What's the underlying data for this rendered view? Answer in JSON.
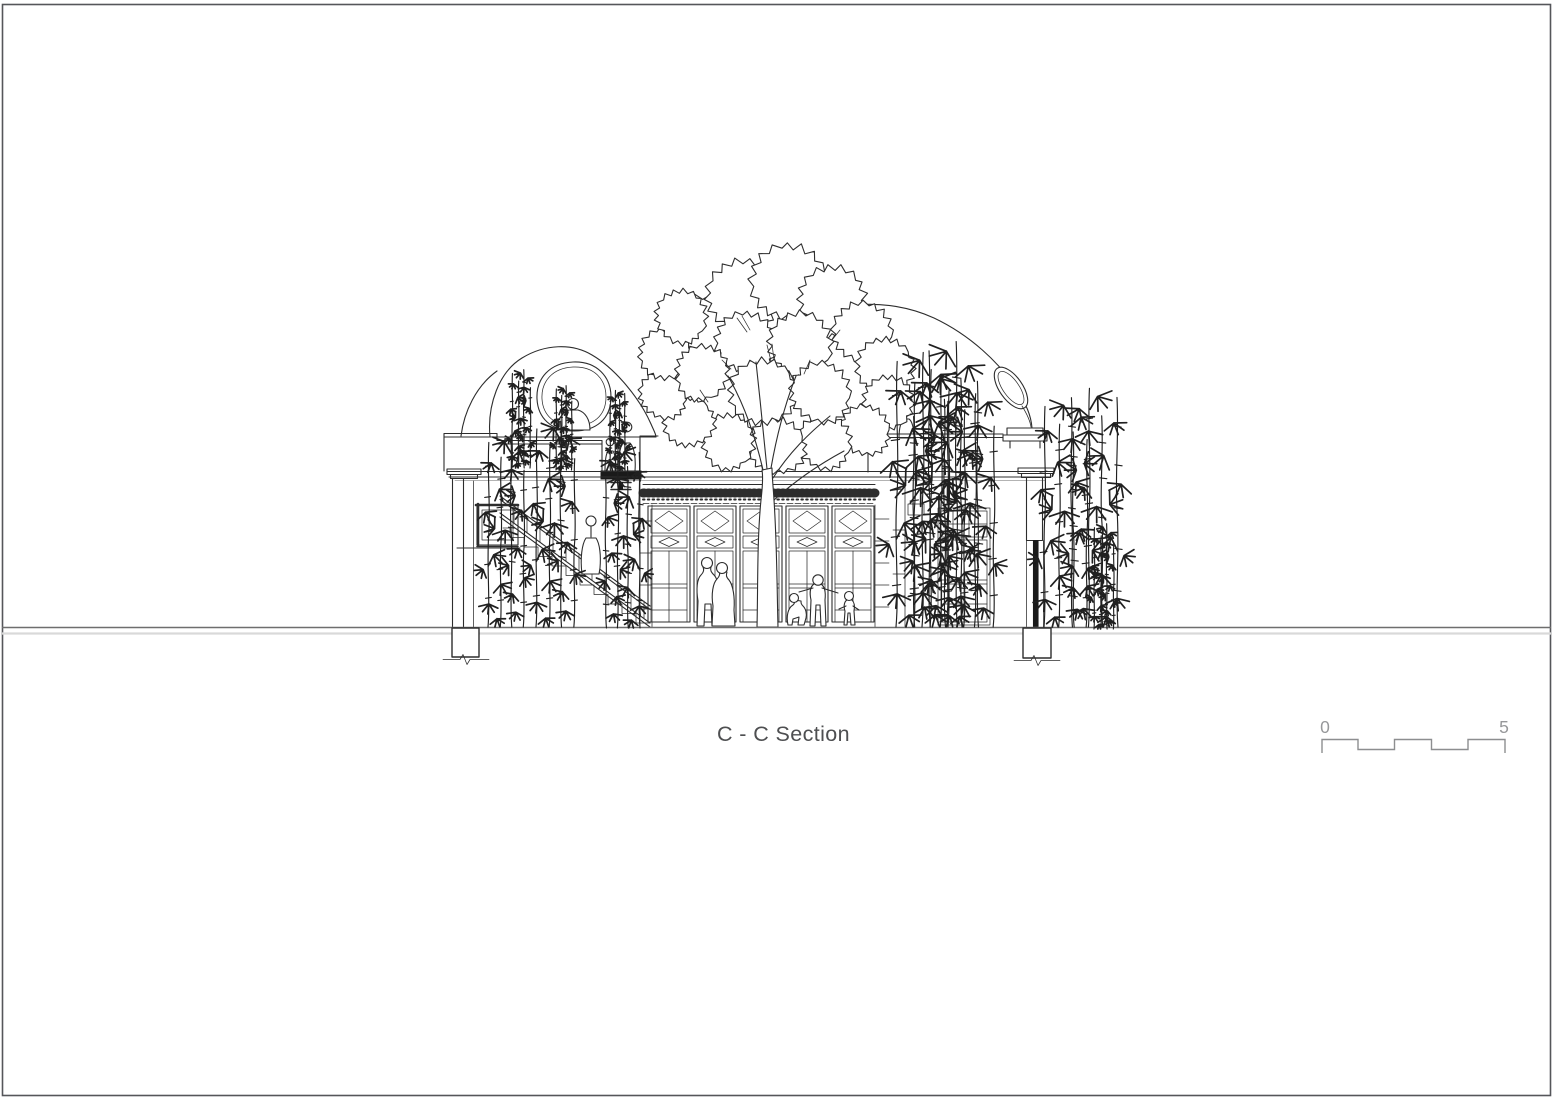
{
  "page": {
    "background": "#ffffff",
    "border_color": "#55565a"
  },
  "drawing": {
    "title": "C - C Section",
    "title_color": "#4e4f51",
    "line_color": "#2d2d2d",
    "cut_fill_color": "#1a1a1a",
    "ground_line_color": "#6e6e6e",
    "ground_shadow_color": "#d9d9d9"
  },
  "scale_bar": {
    "zero_label": "0",
    "five_label": "5",
    "color": "#8d8e90",
    "label_color": "#97989a"
  }
}
